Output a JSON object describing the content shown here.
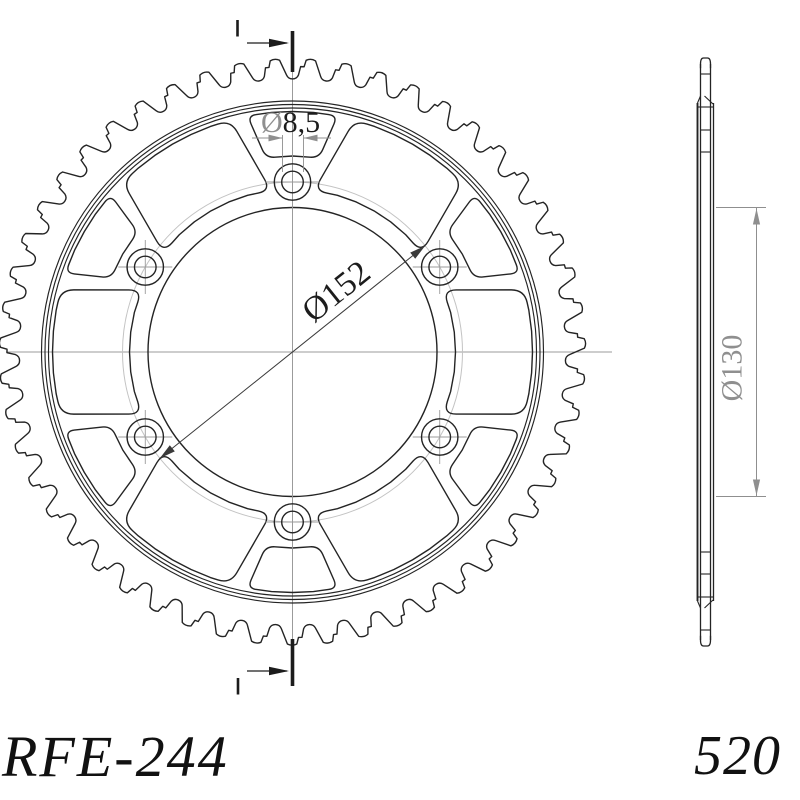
{
  "labels": {
    "part_number": "RFE-244",
    "chain_pitch": "520"
  },
  "dimensions": {
    "bolt_hole": {
      "symbol": "Ø",
      "value": "8,5",
      "full": "Ø8,5"
    },
    "bolt_circle": {
      "full": "Ø152"
    },
    "inner_bore": {
      "full": "Ø130"
    }
  },
  "colors": {
    "outline": "#242424",
    "centerline": "#9b9b9b",
    "dimension": "#8f8f8f",
    "bolt_circle_line": "#c3c3c3",
    "dim_line_dark": "#3a3a3a",
    "text_dark": "#1c1c1c",
    "background": "#ffffff"
  },
  "front_view": {
    "cx": 292.5,
    "cy": 352,
    "teeth": 51,
    "tip_radius": 292,
    "flank_radius": 277,
    "notch_radius": 285.5,
    "rim_radii": [
      251,
      247.5,
      244
    ],
    "bore_radius": 144.5,
    "bolt_circle_radius": 170,
    "bolt_hole_radius": 10.8,
    "bolt_boss_radius": 18.2,
    "bolt_angles": [
      0,
      60,
      120,
      180,
      240,
      300
    ],
    "window_angles": [
      30,
      90,
      150,
      210,
      270,
      330
    ],
    "large_window": {
      "outer_r": 240,
      "inner_r": 163,
      "outer_half": 15,
      "inner_half": 22.4,
      "corner_r": 13
    },
    "small_window": {
      "outer_r": 240.5,
      "inner_r": 196,
      "outer_half": 10.8,
      "inner_half": 7.8,
      "corner_r": 9
    }
  },
  "side_view": {
    "face_left_outer": 697.5,
    "face_left_inner": 700.5,
    "face_right_inner": 710.5,
    "face_right_outer": 713.5,
    "tip_top": 58,
    "cap_round": 6,
    "inner_top": 64,
    "plate_top": 103,
    "narrow_lines": [
      74,
      130,
      152
    ],
    "full_lines": [
      107
    ],
    "mirror_cy": 352
  },
  "dim152": {
    "radius": 170,
    "angle_deg": 51.3,
    "text_x": 343,
    "text_y": 300,
    "text_rot": -38.7
  },
  "dim85": {
    "ext_x1": 282.5,
    "ext_x2": 303.5,
    "ext_y_top": 135,
    "ext_y_bot": 172,
    "line_y": 138,
    "tail_left": 252,
    "tail_right": 331,
    "text_x": 261,
    "text_y": 132
  },
  "dim130": {
    "ext_y1": 207.5,
    "ext_y2": 496.5,
    "ext_x1": 716,
    "ext_x2": 766,
    "line_x": 756.5,
    "text_x": 741.5,
    "text_y": 368
  },
  "section_marks": {
    "top": {
      "bar_x": 292.5,
      "bar_y1": 31,
      "bar_y2": 72,
      "arrow_y": 43,
      "arrow_x1": 247,
      "arrow_tip": 289,
      "tick_x": 237.5,
      "tick_y1": 20,
      "tick_y2": 36.5
    },
    "bottom": {
      "bar_x": 292.5,
      "bar_y1": 639,
      "bar_y2": 686,
      "arrow_y": 671,
      "arrow_x1": 247,
      "arrow_tip": 289,
      "tick_x": 238,
      "tick_y1": 678,
      "tick_y2": 694.5
    },
    "centerline_v": {
      "x": 292.5,
      "y1": 70,
      "y2": 640
    },
    "centerline_h": {
      "y": 352,
      "x1": 6,
      "x2": 612
    }
  }
}
